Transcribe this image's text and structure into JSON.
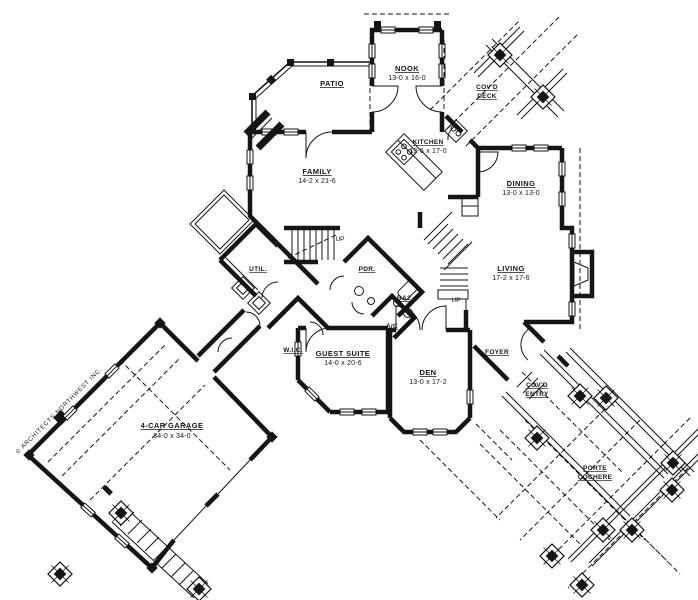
{
  "drawing": {
    "copyright": "© ARCHITECTS NORTHWEST INC.",
    "accent_color": "#151515",
    "background_color": "#ffffff",
    "labels": {
      "up": "UP"
    },
    "rooms": {
      "patio": {
        "name": "PATIO"
      },
      "nook": {
        "name": "NOOK",
        "dims": "13-0 x 16-0"
      },
      "covd_deck": {
        "line1": "COV'D",
        "line2": "DECK"
      },
      "kitchen": {
        "name": "KITCHEN",
        "dims": "13-6 x 17-0"
      },
      "family": {
        "name": "FAMILY",
        "dims": "14-2 x 21-6"
      },
      "dining": {
        "name": "DINING",
        "dims": "13-0 x 13-0"
      },
      "living": {
        "name": "LIVING",
        "dims": "17-2 x 17-6"
      },
      "util": {
        "name": "UTIL."
      },
      "pdr": {
        "name": "PDR."
      },
      "ba2": {
        "name": "BA2"
      },
      "wic": {
        "name": "W.I.C."
      },
      "ac": {
        "name": "A/C"
      },
      "guest": {
        "name": "GUEST SUITE",
        "dims": "14-0 x 20-6"
      },
      "den": {
        "name": "DEN",
        "dims": "13-0 x 17-2"
      },
      "foyer": {
        "name": "FOYER"
      },
      "covd_entry": {
        "line1": "COV'D",
        "line2": "ENTRY"
      },
      "porte": {
        "line1": "PORTE",
        "line2": "COCHERE"
      },
      "garage": {
        "name": "4-CAR GARAGE",
        "dims": "34-0 x 34-0"
      }
    }
  }
}
